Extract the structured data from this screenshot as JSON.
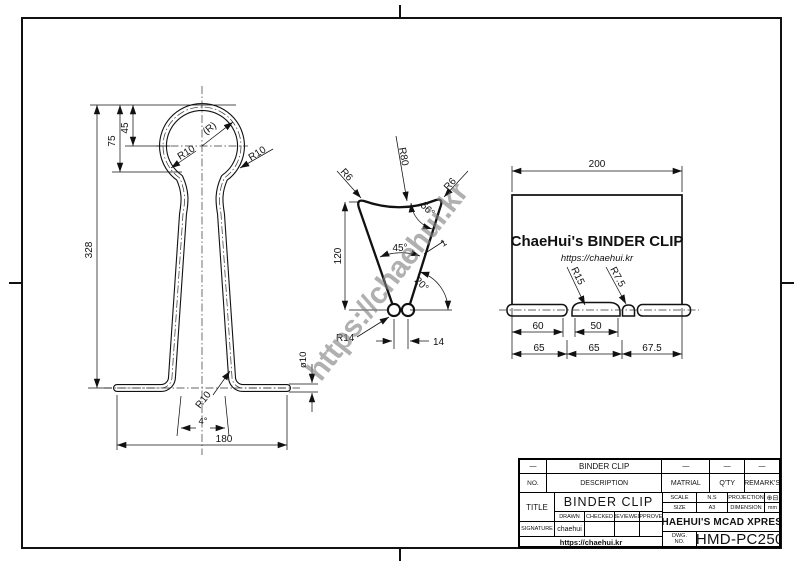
{
  "watermark": {
    "text": "https://chaehui.kr"
  },
  "front": {
    "d328": "328",
    "d75": "75",
    "d45": "45",
    "r_ref": "(R)",
    "r10_left": "R10",
    "r10_right": "R10",
    "r10_bottom": "R10",
    "a4": "4°",
    "d180": "180",
    "dia10": "ø10"
  },
  "side": {
    "d120": "120",
    "d14": "14",
    "r80": "R80",
    "r6_left": "R6",
    "r6_right": "R6",
    "r14": "R14",
    "a56": "56°",
    "a45": "45°",
    "a20": "20°",
    "t1": "1"
  },
  "plan": {
    "d200": "200",
    "brand": "ChaeHui's BINDER CLIP",
    "url": "https://chaehui.kr",
    "r15": "R15",
    "r7_5": "R7.5",
    "d60": "60",
    "d50": "50",
    "d65a": "65",
    "d65b": "65",
    "d67_5": "67.5"
  },
  "tb": {
    "row1": {
      "c1": "—",
      "c2": "BINDER CLIP",
      "c3": "—",
      "c4": "—",
      "c5": "—"
    },
    "row2": {
      "no": "NO.",
      "description": "DESCRIPTION",
      "matrial": "MATRIAL",
      "qty": "Q'TY",
      "remarks": "REMARK'S"
    },
    "title_label": "TITLE",
    "title_value": "BINDER CLIP",
    "drawn": "DRAWN",
    "checked": "CHECKED",
    "reviewed": "REVIEWED",
    "approved": "APPROVED",
    "signature_label": "SIGNATURE",
    "signature_value": "chaehui",
    "url": "https://chaehui.kr",
    "scale_label": "SCALE",
    "scale_value": "N.S",
    "projection_label": "PROJECTION",
    "projection_symbol": "⊕⊟",
    "size_label": "SIZE",
    "size_value": "A3",
    "dimension_label": "DIMENSION",
    "dimension_value": "mm",
    "company": "CHAEHUI'S MCAD XPRESS",
    "dwg_label_1": "DWG.",
    "dwg_label_2": "NO.",
    "dwg_no": "CHMD-PC2506"
  }
}
